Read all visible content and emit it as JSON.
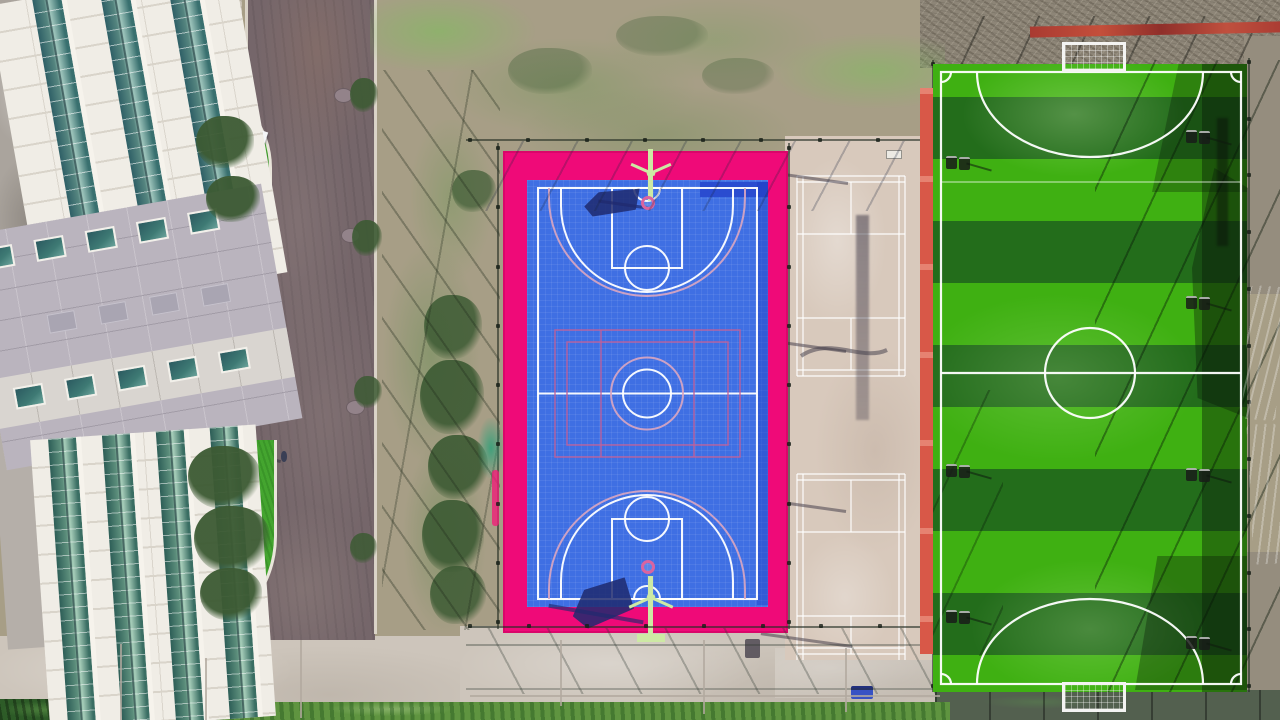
{
  "meta": {
    "type": "aerial-drone-photograph",
    "subject": "top-down view of a sports complex: white school building and road on the left, blue basketball court with magenta apron in the center, beige badminton courts, and a striped green soccer field on the right",
    "width": 1280,
    "height": 720
  },
  "palette": {
    "scrub": "#a79e86",
    "dirtTop": "#8d8577",
    "dirtRight": "#958d7e",
    "road": "#75666a",
    "pavement": "#cdc5bb",
    "pavementJoint": "#b2a99f",
    "courtPink": "#ef0a78",
    "courtBlue": "#3f6fe3",
    "courtBluePatch": "#2a4cd0",
    "courtLine": "#ffffff",
    "overlayLine": "#c65e95",
    "overlayArc": "#dca6c0",
    "beige": "#d8c9bc",
    "fieldBright": "#3fb012",
    "fieldDark": "#236d1b",
    "fieldLine": "#ffffff",
    "redStrip": "#d85848",
    "redBar": "#b23a31",
    "lawn": "#44a52f",
    "bush": "#3c5a33",
    "hedge": "#2d5b27",
    "grassBottom": "#5f9440",
    "bldgWhite": "#f0ede6",
    "panelLine": "#d9d4ca",
    "bldgGray": "#bab4be",
    "glassTeal": "#3f7a78",
    "concrete": "#aaa49d",
    "tanPatch": "#c7bfb2",
    "hoopGreen": "#cde9a4",
    "navyShadow": "rgba(31,42,110,0.85)",
    "tarpBlue": "#1c2b92",
    "tarpMagenta": "#c23fa6",
    "darkTiles": "#53604f"
  },
  "scene": {
    "bushes": [
      {
        "x": 350,
        "y": 78,
        "w": 28,
        "h": 34,
        "o": 0.9
      },
      {
        "x": 352,
        "y": 220,
        "w": 30,
        "h": 36,
        "o": 0.9
      },
      {
        "x": 354,
        "y": 376,
        "w": 28,
        "h": 32,
        "o": 0.85
      },
      {
        "x": 350,
        "y": 533,
        "w": 27,
        "h": 30,
        "o": 0.85
      },
      {
        "x": 452,
        "y": 170,
        "w": 44,
        "h": 42,
        "o": 0.7
      },
      {
        "x": 424,
        "y": 295,
        "w": 58,
        "h": 64,
        "o": 0.85
      },
      {
        "x": 420,
        "y": 360,
        "w": 64,
        "h": 74,
        "o": 0.9
      },
      {
        "x": 428,
        "y": 435,
        "w": 60,
        "h": 64,
        "o": 0.9
      },
      {
        "x": 422,
        "y": 500,
        "w": 62,
        "h": 72,
        "o": 0.9
      },
      {
        "x": 430,
        "y": 566,
        "w": 56,
        "h": 58,
        "o": 0.85
      },
      {
        "x": 508,
        "y": 48,
        "w": 84,
        "h": 46,
        "o": 0.35
      },
      {
        "x": 616,
        "y": 16,
        "w": 92,
        "h": 40,
        "o": 0.3
      },
      {
        "x": 702,
        "y": 58,
        "w": 72,
        "h": 36,
        "o": 0.3
      },
      {
        "x": 196,
        "y": 116,
        "w": 58,
        "h": 52,
        "o": 0.95
      },
      {
        "x": 206,
        "y": 176,
        "w": 54,
        "h": 46,
        "o": 0.95
      },
      {
        "x": 188,
        "y": 446,
        "w": 72,
        "h": 62,
        "o": 0.95
      },
      {
        "x": 194,
        "y": 506,
        "w": 76,
        "h": 66,
        "o": 0.95
      },
      {
        "x": 200,
        "y": 568,
        "w": 62,
        "h": 52,
        "o": 0.95
      }
    ],
    "fencePosts": [
      {
        "x0": 470,
        "y0": 140,
        "x1": 936,
        "y1": 140,
        "n": 9
      },
      {
        "x0": 498,
        "y0": 148,
        "x1": 498,
        "y1": 622,
        "n": 9
      },
      {
        "x0": 789,
        "y0": 148,
        "x1": 789,
        "y1": 622,
        "n": 9
      },
      {
        "x0": 470,
        "y0": 626,
        "x1": 938,
        "y1": 626,
        "n": 9
      },
      {
        "x0": 933,
        "y0": 64,
        "x1": 933,
        "y1": 686,
        "n": 12
      },
      {
        "x0": 1249,
        "y0": 62,
        "x1": 1249,
        "y1": 686,
        "n": 12
      }
    ],
    "manholes": [
      {
        "x": 334,
        "y": 88
      },
      {
        "x": 341,
        "y": 228
      },
      {
        "x": 346,
        "y": 400
      }
    ],
    "beigePoleShadows": [
      {
        "x": 836,
        "y": 182
      },
      {
        "x": 834,
        "y": 350
      },
      {
        "x": 834,
        "y": 510
      },
      {
        "x": 840,
        "y": 645
      }
    ],
    "fieldFixtures": [
      {
        "x": 946,
        "y": 156
      },
      {
        "x": 946,
        "y": 464
      },
      {
        "x": 946,
        "y": 610
      },
      {
        "x": 1186,
        "y": 130
      },
      {
        "x": 1186,
        "y": 296
      },
      {
        "x": 1186,
        "y": 468
      },
      {
        "x": 1186,
        "y": 636
      }
    ],
    "pavementJoints": [
      {
        "x": 300,
        "y": 640,
        "h": 78
      },
      {
        "x": 205,
        "y": 658,
        "h": 62
      },
      {
        "x": 560,
        "y": 640,
        "h": 66
      },
      {
        "x": 703,
        "y": 640,
        "h": 74
      },
      {
        "x": 845,
        "y": 648,
        "h": 64
      },
      {
        "x": 120,
        "y": 644,
        "h": 76
      }
    ],
    "building": {
      "graybandWindowRows": {
        "top": {
          "y": 16,
          "w": 30,
          "h": 22,
          "xs": [
            14,
            66,
            118,
            170,
            222
          ],
          "faint": false
        },
        "middle": {
          "y": 92,
          "w": 28,
          "h": 19,
          "xs": [
            66,
            118,
            170,
            222
          ],
          "faint": true
        },
        "bottom": {
          "y": 158,
          "w": 30,
          "h": 22,
          "xs": [
            20,
            72,
            124,
            176,
            228
          ],
          "faint": false
        }
      }
    }
  }
}
